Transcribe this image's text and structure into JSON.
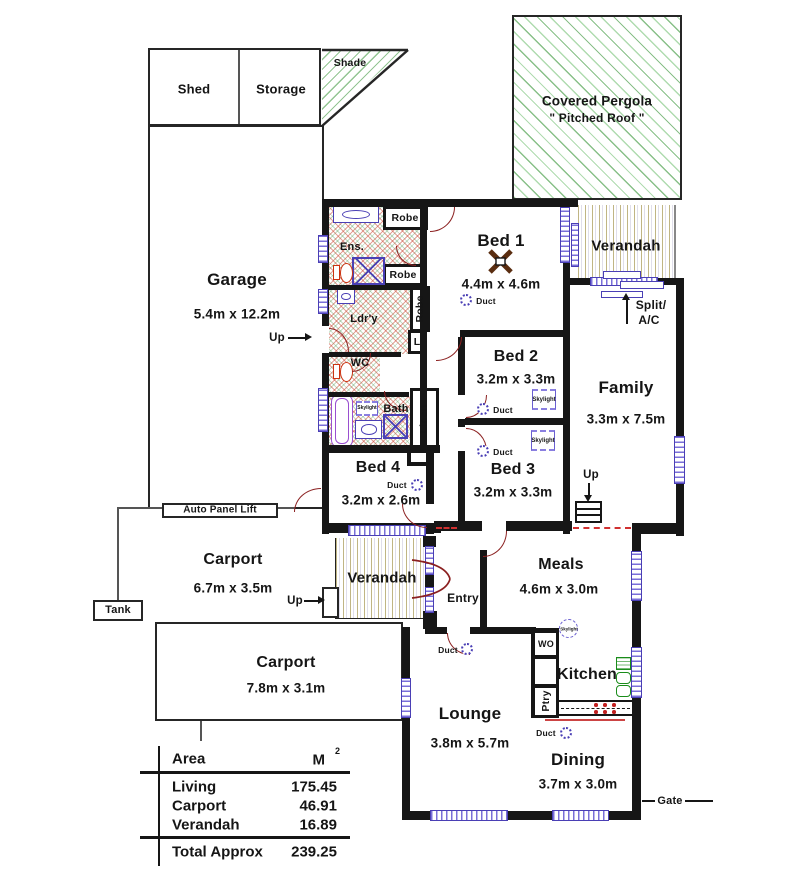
{
  "plan": {
    "rooms": [
      {
        "name": "Garage",
        "dims": "5.4m x 12.2m"
      },
      {
        "name": "Bed 1",
        "dims": "4.4m x 4.6m"
      },
      {
        "name": "Bed 2",
        "dims": "3.2m x 3.3m"
      },
      {
        "name": "Bed 3",
        "dims": "3.2m x 3.3m"
      },
      {
        "name": "Bed 4",
        "dims": "3.2m x 2.6m"
      },
      {
        "name": "Family",
        "dims": "3.3m x 7.5m"
      },
      {
        "name": "Meals",
        "dims": "4.6m x 3.0m"
      },
      {
        "name": "Carport",
        "dims": "6.7m x 3.5m"
      },
      {
        "name": "Carport",
        "dims": "7.8m x 3.1m"
      },
      {
        "name": "Lounge",
        "dims": "3.8m x 5.7m"
      },
      {
        "name": "Dining",
        "dims": "3.7m x 3.0m"
      },
      {
        "name": "Kitchen",
        "dims": ""
      }
    ],
    "outbuildings": {
      "shed": "Shed",
      "storage": "Storage",
      "shade": "Shade",
      "tank": "Tank"
    },
    "pergola": {
      "line1": "Covered Pergola",
      "line2": "\" Pitched Roof \""
    },
    "verandah": "Verandah",
    "entry": "Entry",
    "small": {
      "ens": "Ens.",
      "ldry": "Ldr'y",
      "wc": "WC",
      "bath": "Bath",
      "linen": "Linen",
      "robe": "Robe",
      "l": "L",
      "wo": "WO",
      "ptry": "Ptry"
    },
    "ann": {
      "up": "Up",
      "duct": "Duct",
      "skylight": "Skylight",
      "split1": "Split/",
      "split2": "A/C",
      "gate": "Gate",
      "auto_panel_lift": "Auto Panel Lift"
    }
  },
  "area_table": {
    "header": {
      "area": "Area",
      "unit": "M",
      "unit_sup": "2"
    },
    "rows": [
      {
        "label": "Living",
        "value": "175.45"
      },
      {
        "label": "Carport",
        "value": "46.91"
      },
      {
        "label": "Verandah",
        "value": "16.89"
      }
    ],
    "total": {
      "label": "Total Approx",
      "value": "239.25"
    }
  },
  "colors": {
    "wall": "#161616",
    "window": "#4a3fb5",
    "door": "#8b2020",
    "hatch_green": "#2a8c2a",
    "hatch_tan": "#8c7c1e",
    "wet_red": "#c8463c",
    "fixture_red": "#cc3311",
    "sink_green": "#1a8c1a"
  }
}
